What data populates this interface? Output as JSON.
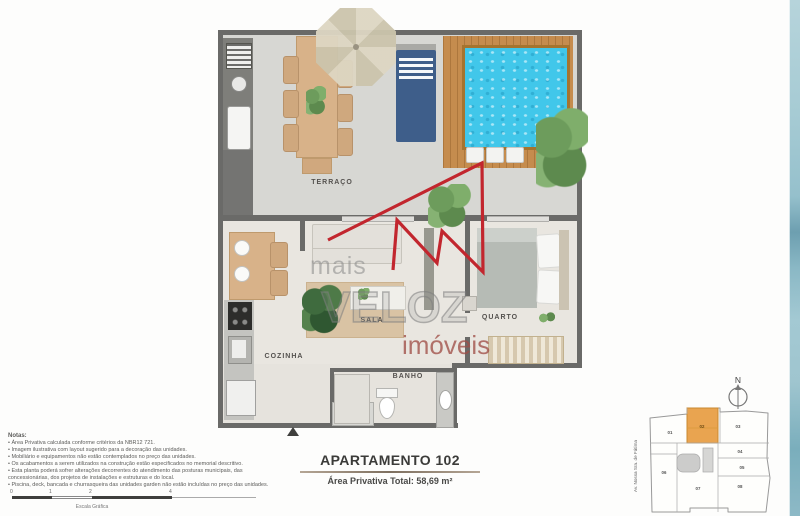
{
  "watermark": {
    "top": "mais",
    "middle": "VELOZ",
    "bottom": "imóveis"
  },
  "rooms": {
    "terraco": "TERRAÇO",
    "sala": "SALA",
    "quarto": "QUARTO",
    "cozinha": "COZINHA",
    "banho": "BANHO"
  },
  "title_block": {
    "title": "APARTAMENTO 102",
    "subtitle": "Área Privativa Total: 58,69 m²"
  },
  "notes": {
    "heading": "Notas:",
    "items": [
      "Área Privativa calculada conforme critérios da NBR12 721.",
      "Imagem ilustrativa com layout sugerido para a decoração das unidades.",
      "Mobiliário e equipamentos não estão contemplados no preço das unidades.",
      "Os acabamentos a serem utilizados na construção estão especificados no memorial descritivo.",
      "Esta planta poderá sofrer alterações decorrentes do atendimento das posturas municipais, das concessionárias, dos projetos de instalações e estruturas e do local.",
      "Piscina, deck, bancada e churrasqueira das unidades garden não estão incluídas no preço das unidades."
    ]
  },
  "scale_bar": {
    "ticks": [
      "0",
      "1",
      "2",
      "4"
    ],
    "label": "Escala Gráfica"
  },
  "key_plan": {
    "compass_label": "N",
    "street_label": "Av. Nossa Sra. de Fátima",
    "highlighted_unit": "02",
    "units": [
      "01",
      "02",
      "03",
      "04",
      "05",
      "06",
      "07",
      "08"
    ]
  },
  "colors": {
    "accent_red": "#c2262e",
    "pool_water": "#41c7ea",
    "deck_wood": "#c58c4e",
    "key_plan_highlight": "#e9a450",
    "side_band_teal": "#8fbccb"
  }
}
